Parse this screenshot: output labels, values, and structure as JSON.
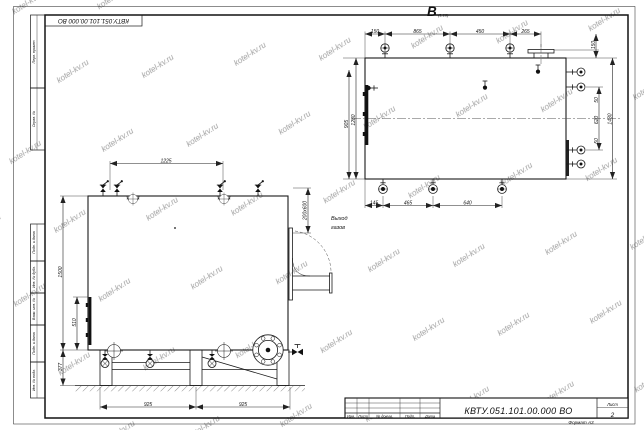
{
  "watermark": "kotel-kv.ru",
  "frame": {
    "top_designation": "КВТУ.051.101.00.000 ВО",
    "left_labels": [
      "Перв. примен.",
      "Справ. №",
      "Подп. и дата",
      "Инв. № дубл.",
      "Взам. инв. №",
      "Подп. и дата",
      "Инв. № подл."
    ]
  },
  "title_block": {
    "designation": "КВТУ.051.101.00.000 ВО",
    "col_izm": "Изм.",
    "col_list": "Лист",
    "col_doc": "№ докум.",
    "col_sign": "Подп.",
    "col_date": "Дата",
    "sheet_label": "Лист",
    "sheet_number": "2",
    "format": "Формат А3"
  },
  "front_view": {
    "dim_span": "1225",
    "dim_height": "1500",
    "dim_hatch": "510",
    "dim_support": "377",
    "dim_base_left": "925",
    "dim_base_right": "925",
    "duct_size": "200x600",
    "outlet_line1": "Выход",
    "outlet_line2": "газов"
  },
  "top_view": {
    "label": "В",
    "scale": "(1:10)",
    "dims_top": [
      "150",
      "865",
      "450",
      "265"
    ],
    "dims_bottom": [
      "145",
      "465",
      "640"
    ],
    "dim_left_outer": "905",
    "dim_left_inner": "1280",
    "dim_right_top": "150",
    "dims_right": [
      "50",
      "620",
      "50"
    ],
    "dim_right_outer": "1430"
  }
}
